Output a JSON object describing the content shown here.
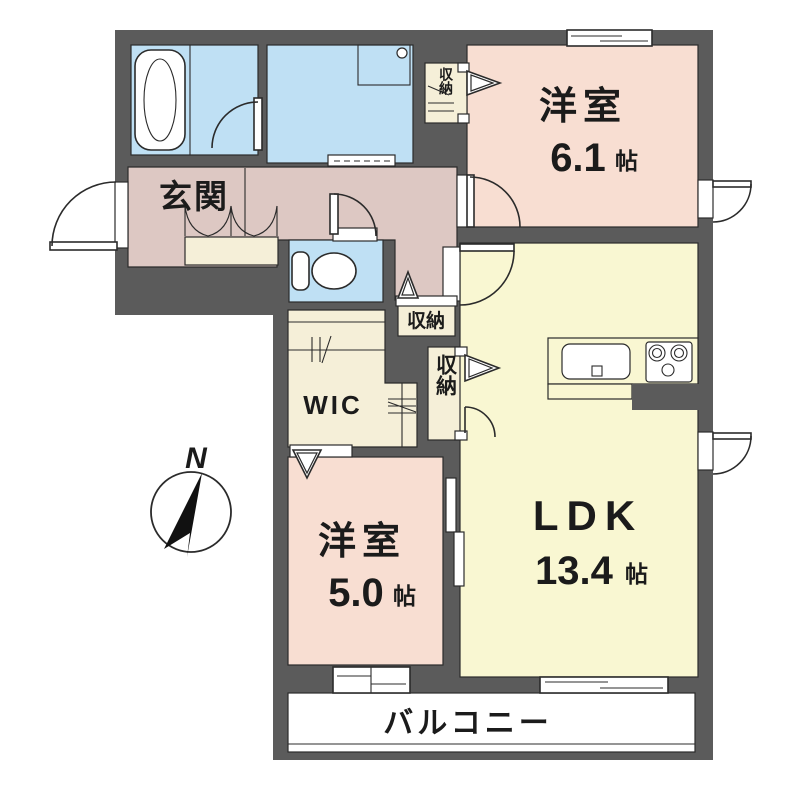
{
  "plan": {
    "compass": {
      "label": "N"
    },
    "balcony": {
      "label": "バルコニー"
    },
    "size_unit": "帖",
    "rooms": {
      "entrance": {
        "label": "玄関"
      },
      "western1": {
        "label": "洋室",
        "size": "6.1"
      },
      "western2": {
        "label": "洋室",
        "size": "5.0"
      },
      "ldk": {
        "label": "LDK",
        "size": "13.4"
      },
      "wic": {
        "label": "WIC"
      },
      "storage_top": {
        "label": "収納"
      },
      "storage_mid": {
        "label": "収納"
      },
      "storage_right": {
        "label": "収納"
      }
    },
    "colors": {
      "wall": "#5b5b5b",
      "room_pink": "#f8ded2",
      "hall_pink": "#ddc8c3",
      "ldk_yellow": "#f9f7d2",
      "wet_blue": "#bfe0f4",
      "closet_cream": "#f5efd8",
      "white": "#ffffff"
    }
  }
}
